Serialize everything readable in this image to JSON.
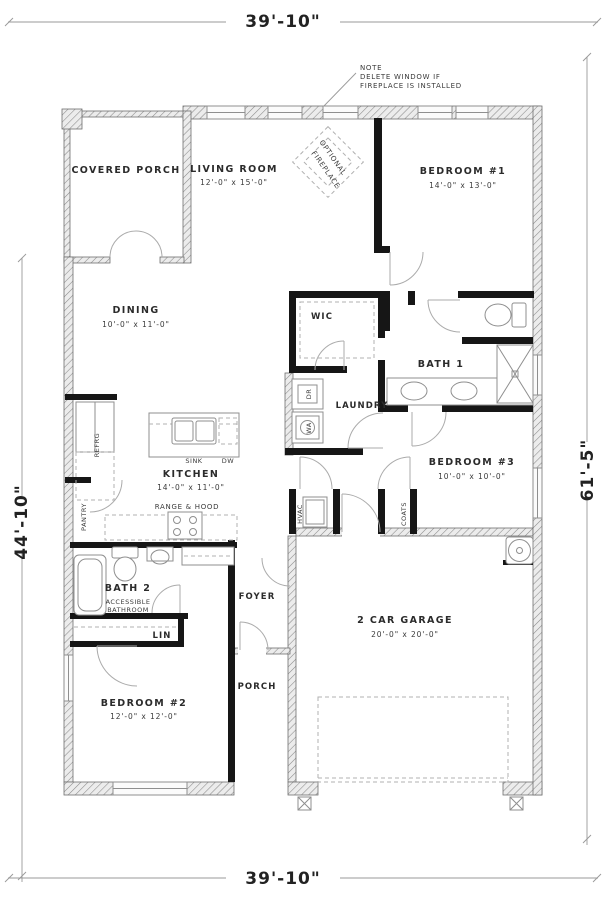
{
  "dimensions": {
    "top": "39'-10\"",
    "bottom": "39'-10\"",
    "left": "44'-10\"",
    "right": "61'-5\""
  },
  "note": {
    "line1": "NOTE",
    "line2": "DELETE WINDOW IF",
    "line3": "FIREPLACE IS INSTALLED"
  },
  "rooms": {
    "covered_porch": {
      "label": "COVERED PORCH"
    },
    "living_room": {
      "label": "LIVING ROOM",
      "dims": "12'-0\" x 15'-0\""
    },
    "optional_fireplace": {
      "line1": "OPTIONAL",
      "line2": "FIREPLACE"
    },
    "bedroom_1": {
      "label": "BEDROOM #1",
      "dims": "14'-0\" x 13'-0\""
    },
    "dining": {
      "label": "DINING",
      "dims": "10'-0\" x 11'-0\""
    },
    "wic": {
      "label": "WIC"
    },
    "bath_1": {
      "label": "BATH 1"
    },
    "laundry": {
      "label": "LAUNDRY"
    },
    "bedroom_3": {
      "label": "BEDROOM #3",
      "dims": "10'-0\" x 10'-0\""
    },
    "kitchen": {
      "label": "KITCHEN",
      "dims": "14'-0\" x 11'-0\""
    },
    "bath_2": {
      "label": "BATH 2",
      "sub_line1": "ACCESSIBLE",
      "sub_line2": "BATHROOM"
    },
    "foyer": {
      "label": "FOYER"
    },
    "lin_closet": {
      "label": "LIN"
    },
    "bedroom_2": {
      "label": "BEDROOM #2",
      "dims": "12'-0\" x 12'-0\""
    },
    "garage": {
      "label": "2 CAR GARAGE",
      "dims": "20'-0\" x 20'-0\""
    },
    "porch": {
      "label": "PORCH"
    }
  },
  "fixtures": {
    "refrigerator": "REFRG",
    "pantry": "PANTRY",
    "sink": "SINK",
    "dishwasher": "DW",
    "range": "RANGE & HOOD",
    "hvac": "HVAC",
    "coats": "COATS",
    "dryer": "DR",
    "washer": "WA"
  },
  "colors": {
    "walls": "#161616",
    "hatch_line": "#8a8a8a",
    "thin_line": "#9a9a9a",
    "text": "#2b2b2b",
    "background": "#ffffff"
  }
}
